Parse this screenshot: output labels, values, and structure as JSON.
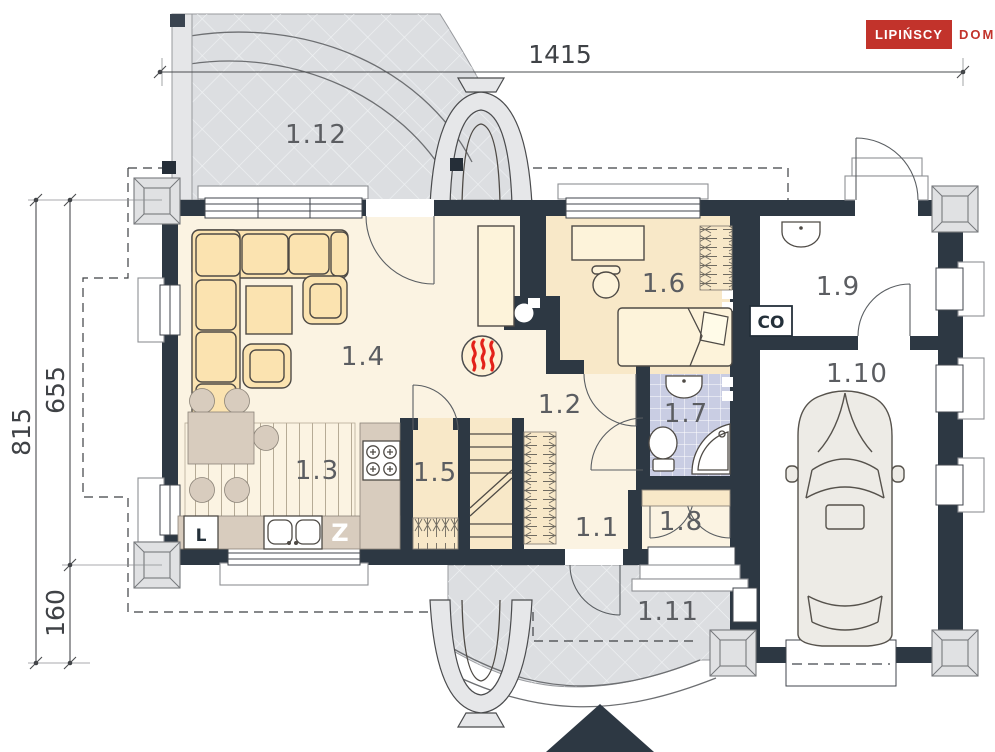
{
  "brand": {
    "name_primary": "LIPIŃSCY",
    "name_secondary": "DOMY"
  },
  "dimensions": {
    "width_total": "1415",
    "height_total": "815",
    "height_main": "655",
    "height_garage_ext": "160"
  },
  "rooms": {
    "hall": "1.1",
    "corridor": "1.2",
    "kitchen": "1.3",
    "living_room": "1.4",
    "pantry": "1.5",
    "bedroom": "1.6",
    "bathroom": "1.7",
    "vestibule": "1.8",
    "boiler_room": "1.9",
    "garage": "1.10",
    "porch": "1.11",
    "terrace": "1.12"
  },
  "markers": {
    "boiler": "CO",
    "fridge": "L",
    "dishwasher": "Z"
  },
  "colors": {
    "wall": "#2d3843",
    "cream": "#fbf3e2",
    "tan": "#f8e8c8",
    "tile": "#c9cde3",
    "terrace": "#dcdee1",
    "counter": "#d8ccbe",
    "furn": "#fbe3b0",
    "bed": "#fdf3da",
    "outline": "#4e4a45",
    "red": "#c2332b",
    "flame": "#e32119",
    "dimtext": "#3f4246",
    "labeltext": "#5b5d61"
  }
}
